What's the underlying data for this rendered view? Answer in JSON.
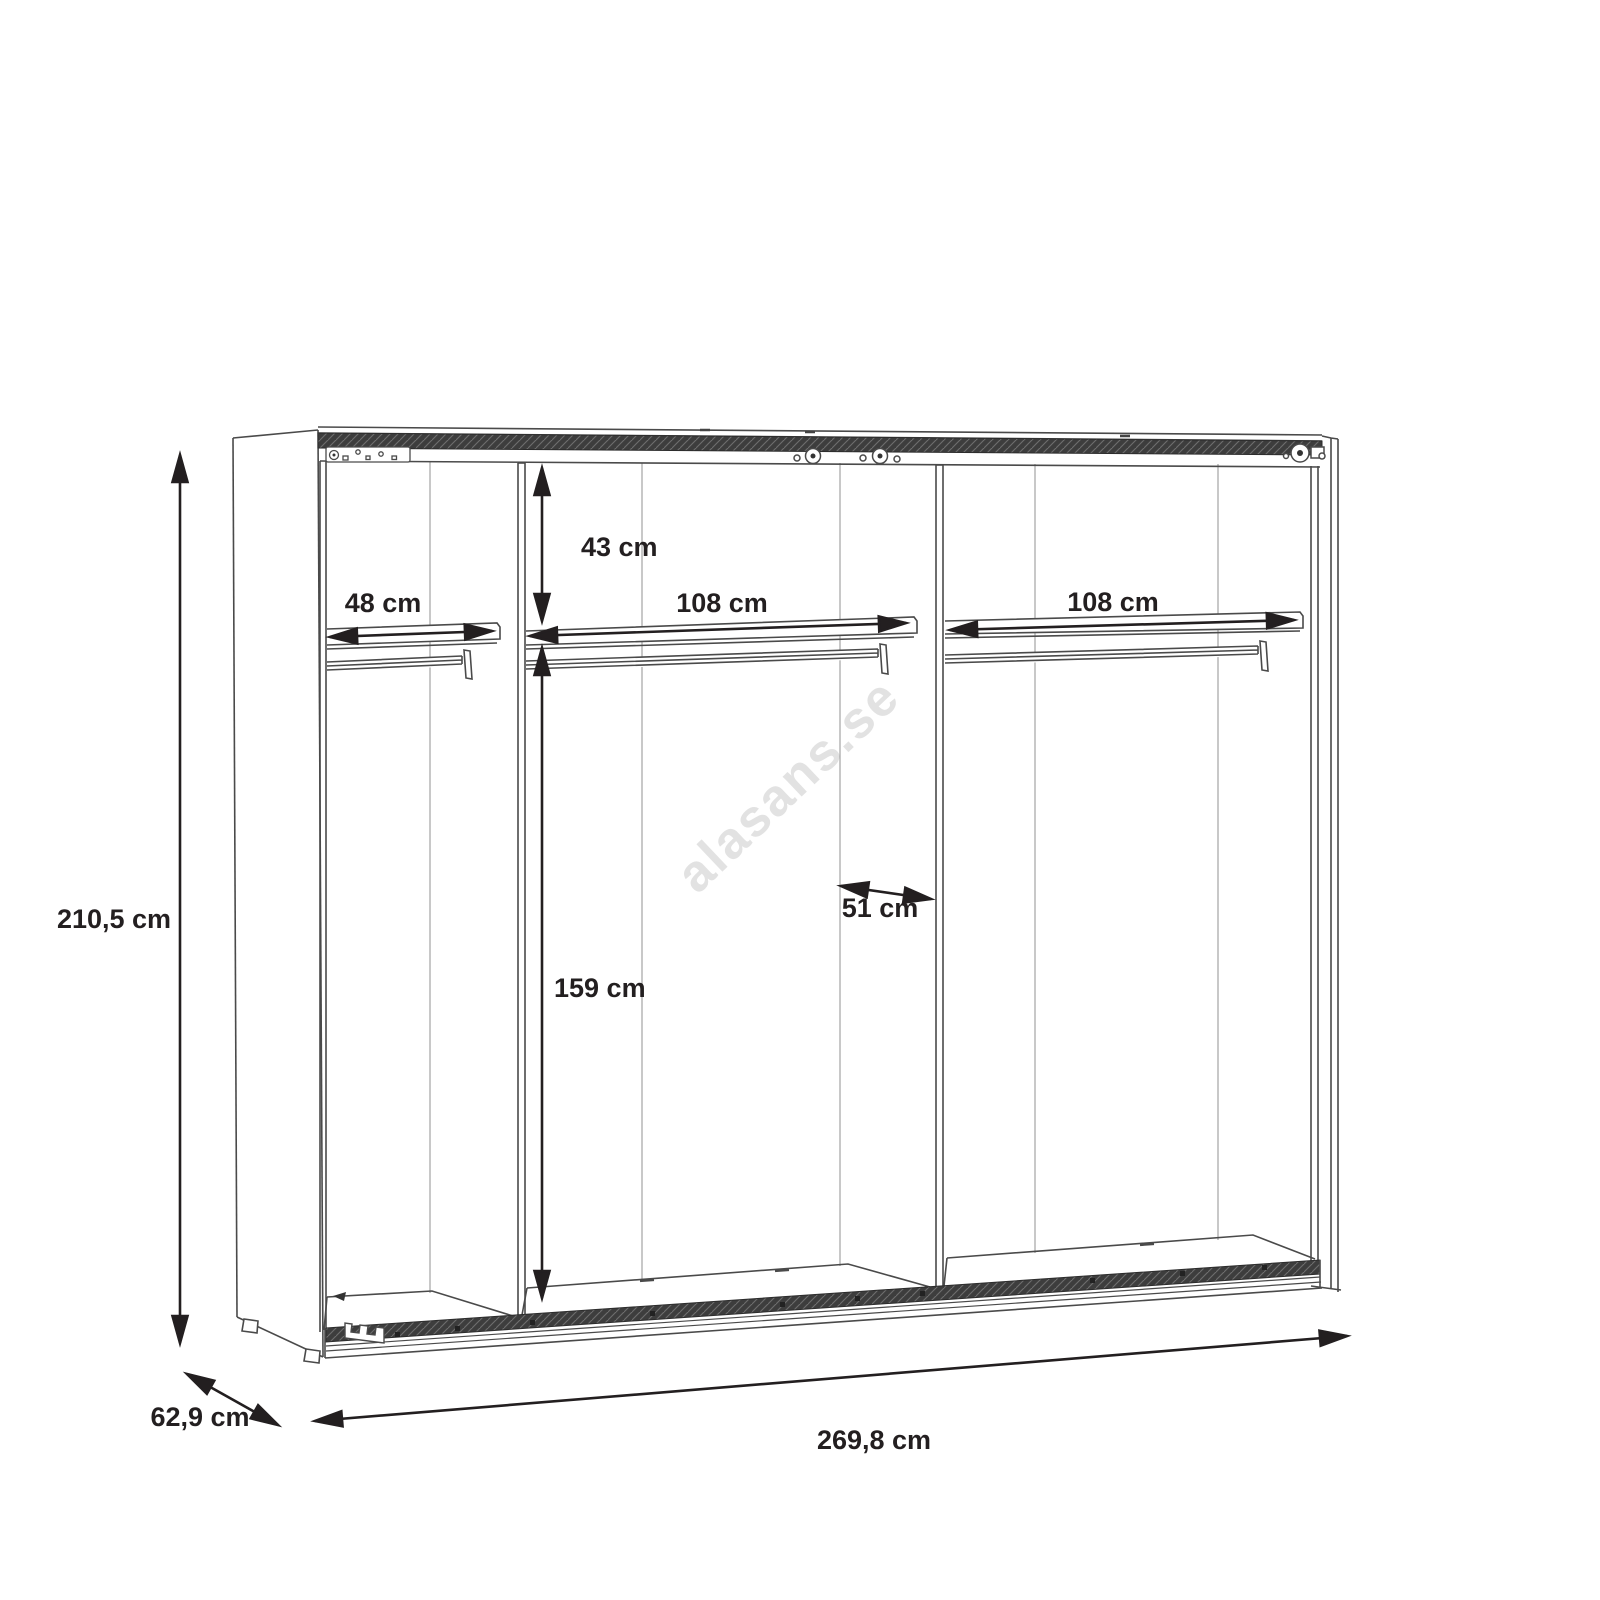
{
  "title": "Wardrobe interior dimensions drawing",
  "watermark": {
    "text": "alasans.se",
    "color": "#e2e2e2"
  },
  "colors": {
    "background": "#ffffff",
    "outline": "#4a4a4a",
    "seam": "#999999",
    "dimension": "#231f20",
    "track_fill": "#3d3d3d"
  },
  "dimensions": {
    "overall_height": {
      "label": "210,5 cm"
    },
    "overall_width": {
      "label": "269,8 cm"
    },
    "overall_depth": {
      "label": "62,9 cm"
    },
    "left_shelf_width": {
      "label": "48 cm"
    },
    "top_shelf_drop": {
      "label": "43 cm"
    },
    "center_shelf_width": {
      "label": "108 cm"
    },
    "right_shelf_width": {
      "label": "108 cm"
    },
    "interior_depth": {
      "label": "51 cm"
    },
    "hanging_height": {
      "label": "159 cm"
    }
  }
}
